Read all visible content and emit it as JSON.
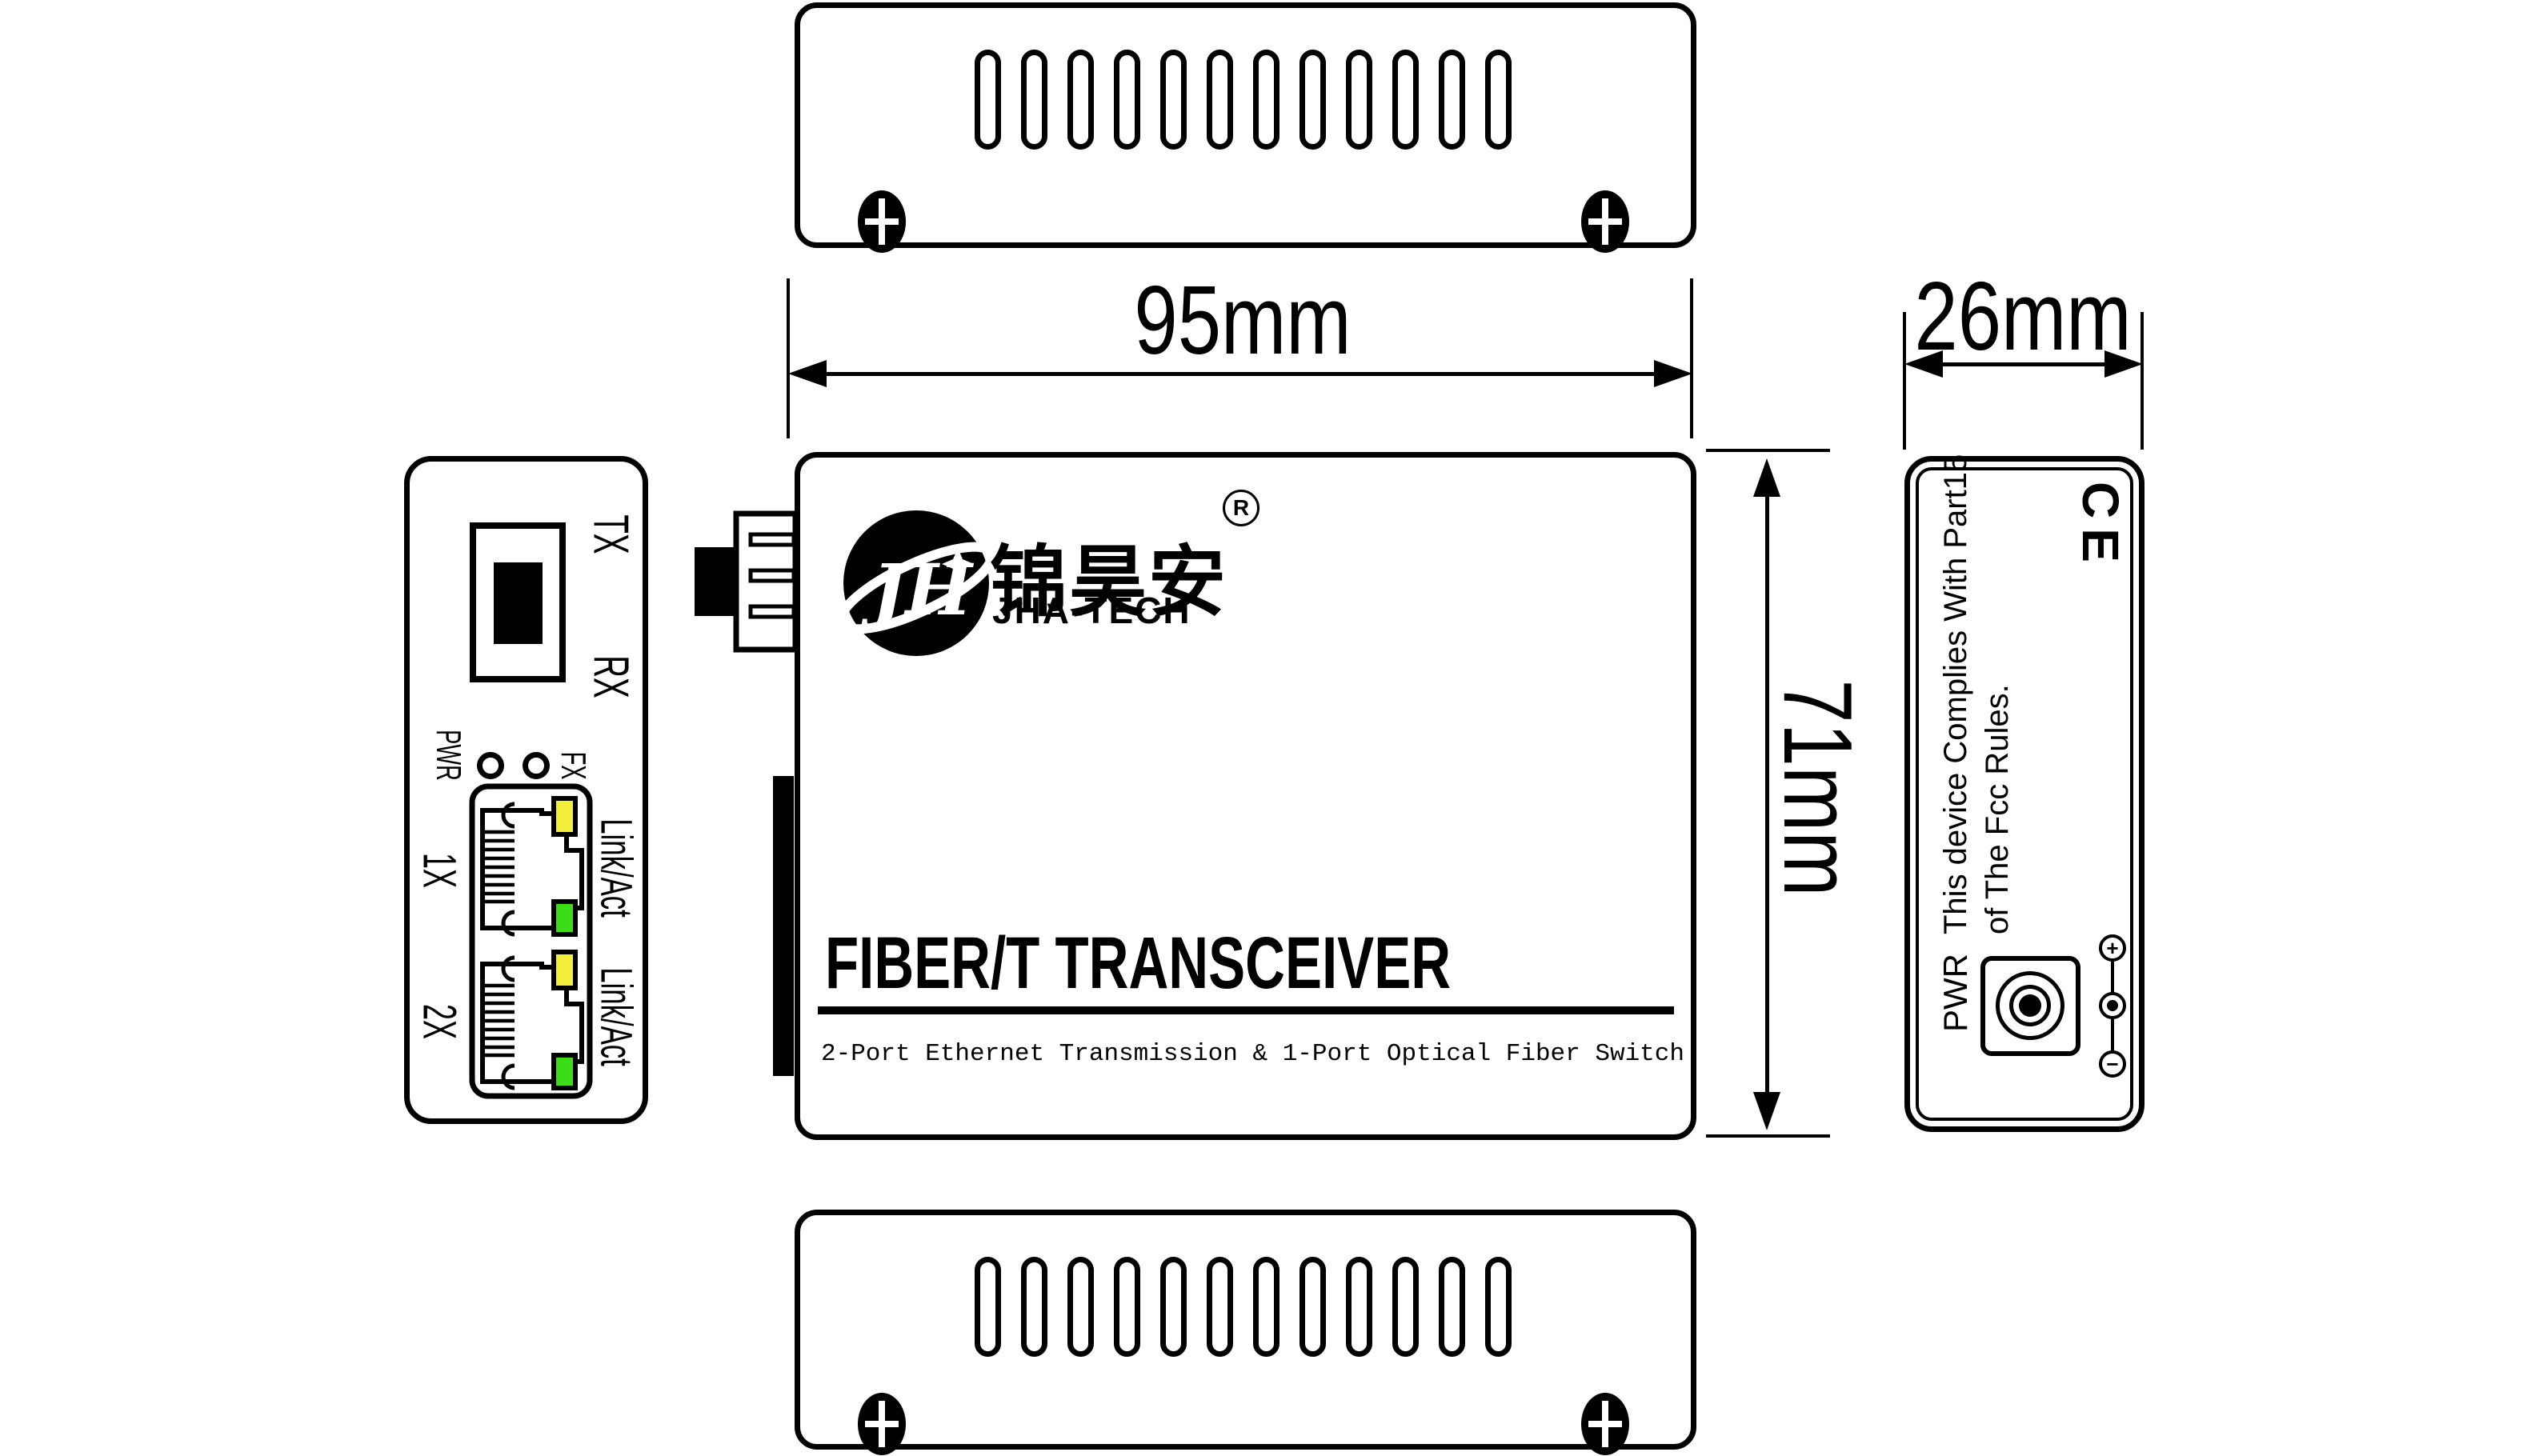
{
  "brand": {
    "logo_monogram": "JH",
    "chinese_name": "锦昊安",
    "registered_mark": "R",
    "latin_name": "JHA-TECH"
  },
  "front": {
    "title": "FIBER/T TRANSCEIVER",
    "subtitle": "2-Port Ethernet Transmission & 1-Port Optical Fiber Switch"
  },
  "dims": {
    "width_label": "95mm",
    "depth_label": "26mm",
    "height_label": "71mm"
  },
  "left_panel": {
    "fiber_tx": "TX",
    "fiber_rx": "RX",
    "led_pwr": "PWR",
    "led_fx": "FX",
    "port1": "1X",
    "port2": "2X",
    "port1_act": "Link/Act",
    "port2_act": "Link/Act"
  },
  "right_panel": {
    "ce_mark": "CE",
    "fcc_line1": "This device Complies With Part15",
    "fcc_line2": "of The Fcc Rules.",
    "pwr": "PWR",
    "polarity_plus": "+",
    "polarity_minus": "−"
  },
  "colors": {
    "led_yellow": "#F2EE3B",
    "led_green": "#3CDC16"
  }
}
